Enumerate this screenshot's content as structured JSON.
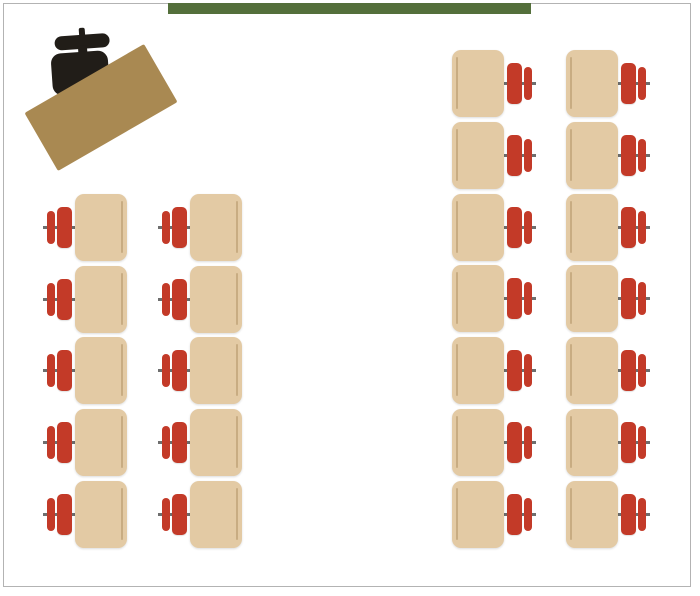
{
  "diagram": {
    "type": "classroom-seating-layout",
    "colors": {
      "background": "#ffffff",
      "frame_border": "#b3b3b3",
      "chalkboard_green": "#546f3b",
      "teacher_desk_brown": "#a98952",
      "teacher_chair_black": "#211d18",
      "student_desk_tan": "#e3caa4",
      "student_desk_edge_line": "#c8ac82",
      "student_chair_red": "#c33a28",
      "chair_post_gray": "#6e6e6e"
    },
    "frame": {
      "x": 3,
      "y": 3,
      "width": 688,
      "height": 584
    },
    "chalkboard": {
      "x": 168,
      "y": 3,
      "width": 363,
      "height": 11
    },
    "teacher_desk": {
      "x": 32,
      "y": 74,
      "width": 138,
      "height": 67,
      "rotation_deg": -30
    },
    "teacher_chair": {
      "x": 45,
      "y": 26,
      "rotation_deg": -4
    },
    "student_desk": {
      "width": 52,
      "height": 67
    },
    "unit": {
      "width": 85,
      "height": 67,
      "flip_offset": 33
    },
    "groups": [
      {
        "name": "left-block",
        "chair_side": "left",
        "desk_columns_x": [
          75,
          190
        ],
        "rows_y": [
          194,
          266,
          337,
          409,
          481
        ],
        "desk_count": 10
      },
      {
        "name": "right-block",
        "chair_side": "right",
        "desk_columns_x": [
          452,
          566
        ],
        "rows_y": [
          50,
          122,
          194,
          265,
          337,
          409,
          481
        ],
        "desk_count": 14
      }
    ],
    "total_student_desks": 24
  }
}
